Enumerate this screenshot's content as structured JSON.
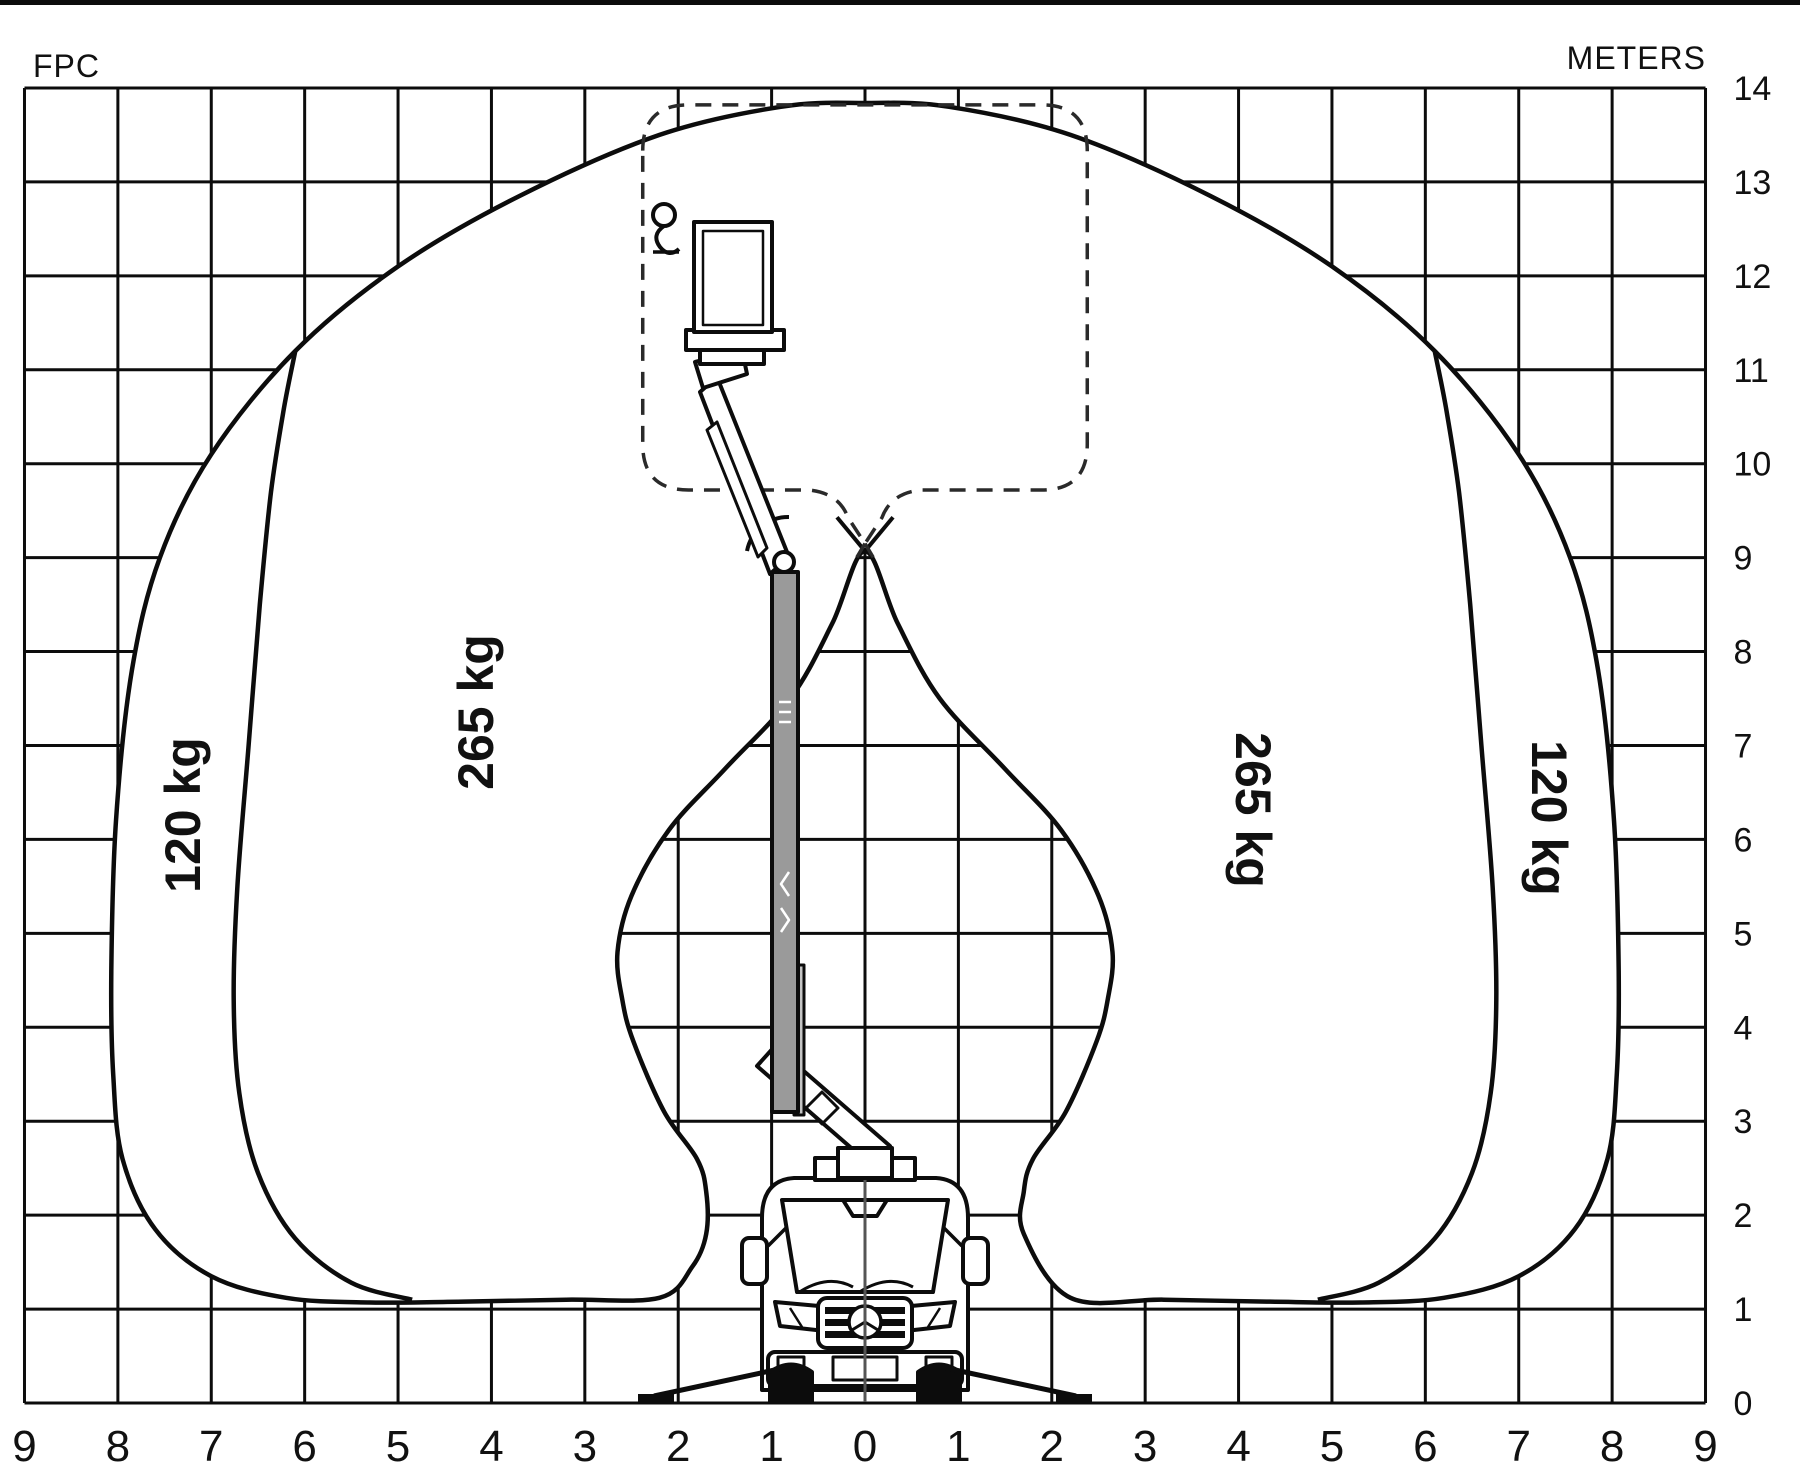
{
  "header": {
    "fpc_label": "FPC",
    "meters_label": "METERS"
  },
  "axes": {
    "x": {
      "unit": "m",
      "ticks": [
        {
          "v": -9,
          "label": "9"
        },
        {
          "v": -8,
          "label": "8"
        },
        {
          "v": -7,
          "label": "7"
        },
        {
          "v": -6,
          "label": "6"
        },
        {
          "v": -5,
          "label": "5"
        },
        {
          "v": -4,
          "label": "4"
        },
        {
          "v": -3,
          "label": "3"
        },
        {
          "v": -2,
          "label": "2"
        },
        {
          "v": -1,
          "label": "1"
        },
        {
          "v": 0,
          "label": "0"
        },
        {
          "v": 1,
          "label": "1"
        },
        {
          "v": 2,
          "label": "2"
        },
        {
          "v": 3,
          "label": "3"
        },
        {
          "v": 4,
          "label": "4"
        },
        {
          "v": 5,
          "label": "5"
        },
        {
          "v": 6,
          "label": "6"
        },
        {
          "v": 7,
          "label": "7"
        },
        {
          "v": 8,
          "label": "8"
        },
        {
          "v": 9,
          "label": "9"
        }
      ]
    },
    "y": {
      "unit": "m",
      "label": "METERS",
      "ticks": [
        {
          "v": 0,
          "label": "0"
        },
        {
          "v": 1,
          "label": "1"
        },
        {
          "v": 2,
          "label": "2"
        },
        {
          "v": 3,
          "label": "3"
        },
        {
          "v": 4,
          "label": "4"
        },
        {
          "v": 5,
          "label": "5"
        },
        {
          "v": 6,
          "label": "6"
        },
        {
          "v": 7,
          "label": "7"
        },
        {
          "v": 8,
          "label": "8"
        },
        {
          "v": 9,
          "label": "9"
        },
        {
          "v": 10,
          "label": "10"
        },
        {
          "v": 11,
          "label": "11"
        },
        {
          "v": 12,
          "label": "12"
        },
        {
          "v": 13,
          "label": "13"
        },
        {
          "v": 14,
          "label": "14"
        }
      ]
    }
  },
  "zones": [
    {
      "id": "left-120",
      "label": "120 kg",
      "capacity_kg": 120,
      "side": "left",
      "region": "outer"
    },
    {
      "id": "left-265",
      "label": "265 kg",
      "capacity_kg": 265,
      "side": "left",
      "region": "inner"
    },
    {
      "id": "right-265",
      "label": "265 kg",
      "capacity_kg": 265,
      "side": "right",
      "region": "inner"
    },
    {
      "id": "right-120",
      "label": "120 kg",
      "capacity_kg": 120,
      "side": "right",
      "region": "outer"
    }
  ],
  "colors": {
    "line": "#0c0c0c",
    "boom_fill": "#9a9a9a",
    "boom_stage2_fill": "#c4c4c4",
    "background": "#ffffff"
  },
  "chart_data": {
    "type": "area",
    "description": "Working range / load envelope of a van-mounted aerial platform, symmetric about x=0",
    "x_axis": {
      "min": -9,
      "max": 9,
      "grid_step": 1,
      "tick_labels_absolute": true
    },
    "y_axis": {
      "min": 0,
      "max": 14,
      "grid_step": 1,
      "label": "METERS"
    },
    "load_capacities_kg": [
      265,
      120
    ],
    "envelope_m": {
      "outer_left": [
        [
          -2.2,
          1.12
        ],
        [
          -3.2,
          1.1
        ],
        [
          -4.3,
          1.08
        ],
        [
          -5.3,
          1.07
        ],
        [
          -6.2,
          1.12
        ],
        [
          -7.0,
          1.35
        ],
        [
          -7.6,
          1.85
        ],
        [
          -7.95,
          2.6
        ],
        [
          -8.05,
          3.5
        ],
        [
          -8.07,
          4.6
        ],
        [
          -8.02,
          6.2
        ],
        [
          -7.85,
          7.8
        ],
        [
          -7.55,
          9.0
        ],
        [
          -7.0,
          10.1
        ],
        [
          -6.1,
          11.2
        ],
        [
          -5.0,
          12.1
        ],
        [
          -3.7,
          12.85
        ],
        [
          -2.2,
          13.5
        ],
        [
          -0.9,
          13.8
        ],
        [
          0,
          13.84
        ]
      ],
      "valley_wall_left": [
        [
          0,
          9.07
        ],
        [
          -0.35,
          8.3
        ],
        [
          -0.8,
          7.5
        ],
        [
          -1.5,
          6.75
        ],
        [
          -2.1,
          6.1
        ],
        [
          -2.5,
          5.4
        ],
        [
          -2.65,
          4.8
        ],
        [
          -2.6,
          4.3
        ],
        [
          -2.48,
          3.85
        ],
        [
          -2.15,
          3.1
        ],
        [
          -1.8,
          2.6
        ],
        [
          -1.7,
          2.25
        ],
        [
          -1.7,
          1.8
        ],
        [
          -1.85,
          1.45
        ],
        [
          -2.2,
          1.12
        ]
      ],
      "inner_boundary_left": [
        [
          -4.85,
          1.1
        ],
        [
          -5.5,
          1.28
        ],
        [
          -6.1,
          1.75
        ],
        [
          -6.5,
          2.45
        ],
        [
          -6.7,
          3.3
        ],
        [
          -6.76,
          4.3
        ],
        [
          -6.72,
          5.5
        ],
        [
          -6.6,
          7.0
        ],
        [
          -6.48,
          8.5
        ],
        [
          -6.36,
          9.7
        ],
        [
          -6.22,
          10.6
        ],
        [
          -6.1,
          11.2
        ]
      ],
      "crossing_point": [
        0,
        9.07
      ],
      "mirrored_about_x0": true
    },
    "dashed_zone_m": {
      "x_left": -2.38,
      "x_right": 2.38,
      "y_top": 13.82,
      "y_bottom": 9.72,
      "corner_radius": 0.49,
      "notch_half_width": 0.6,
      "notch_tip_y": 9.15
    }
  }
}
